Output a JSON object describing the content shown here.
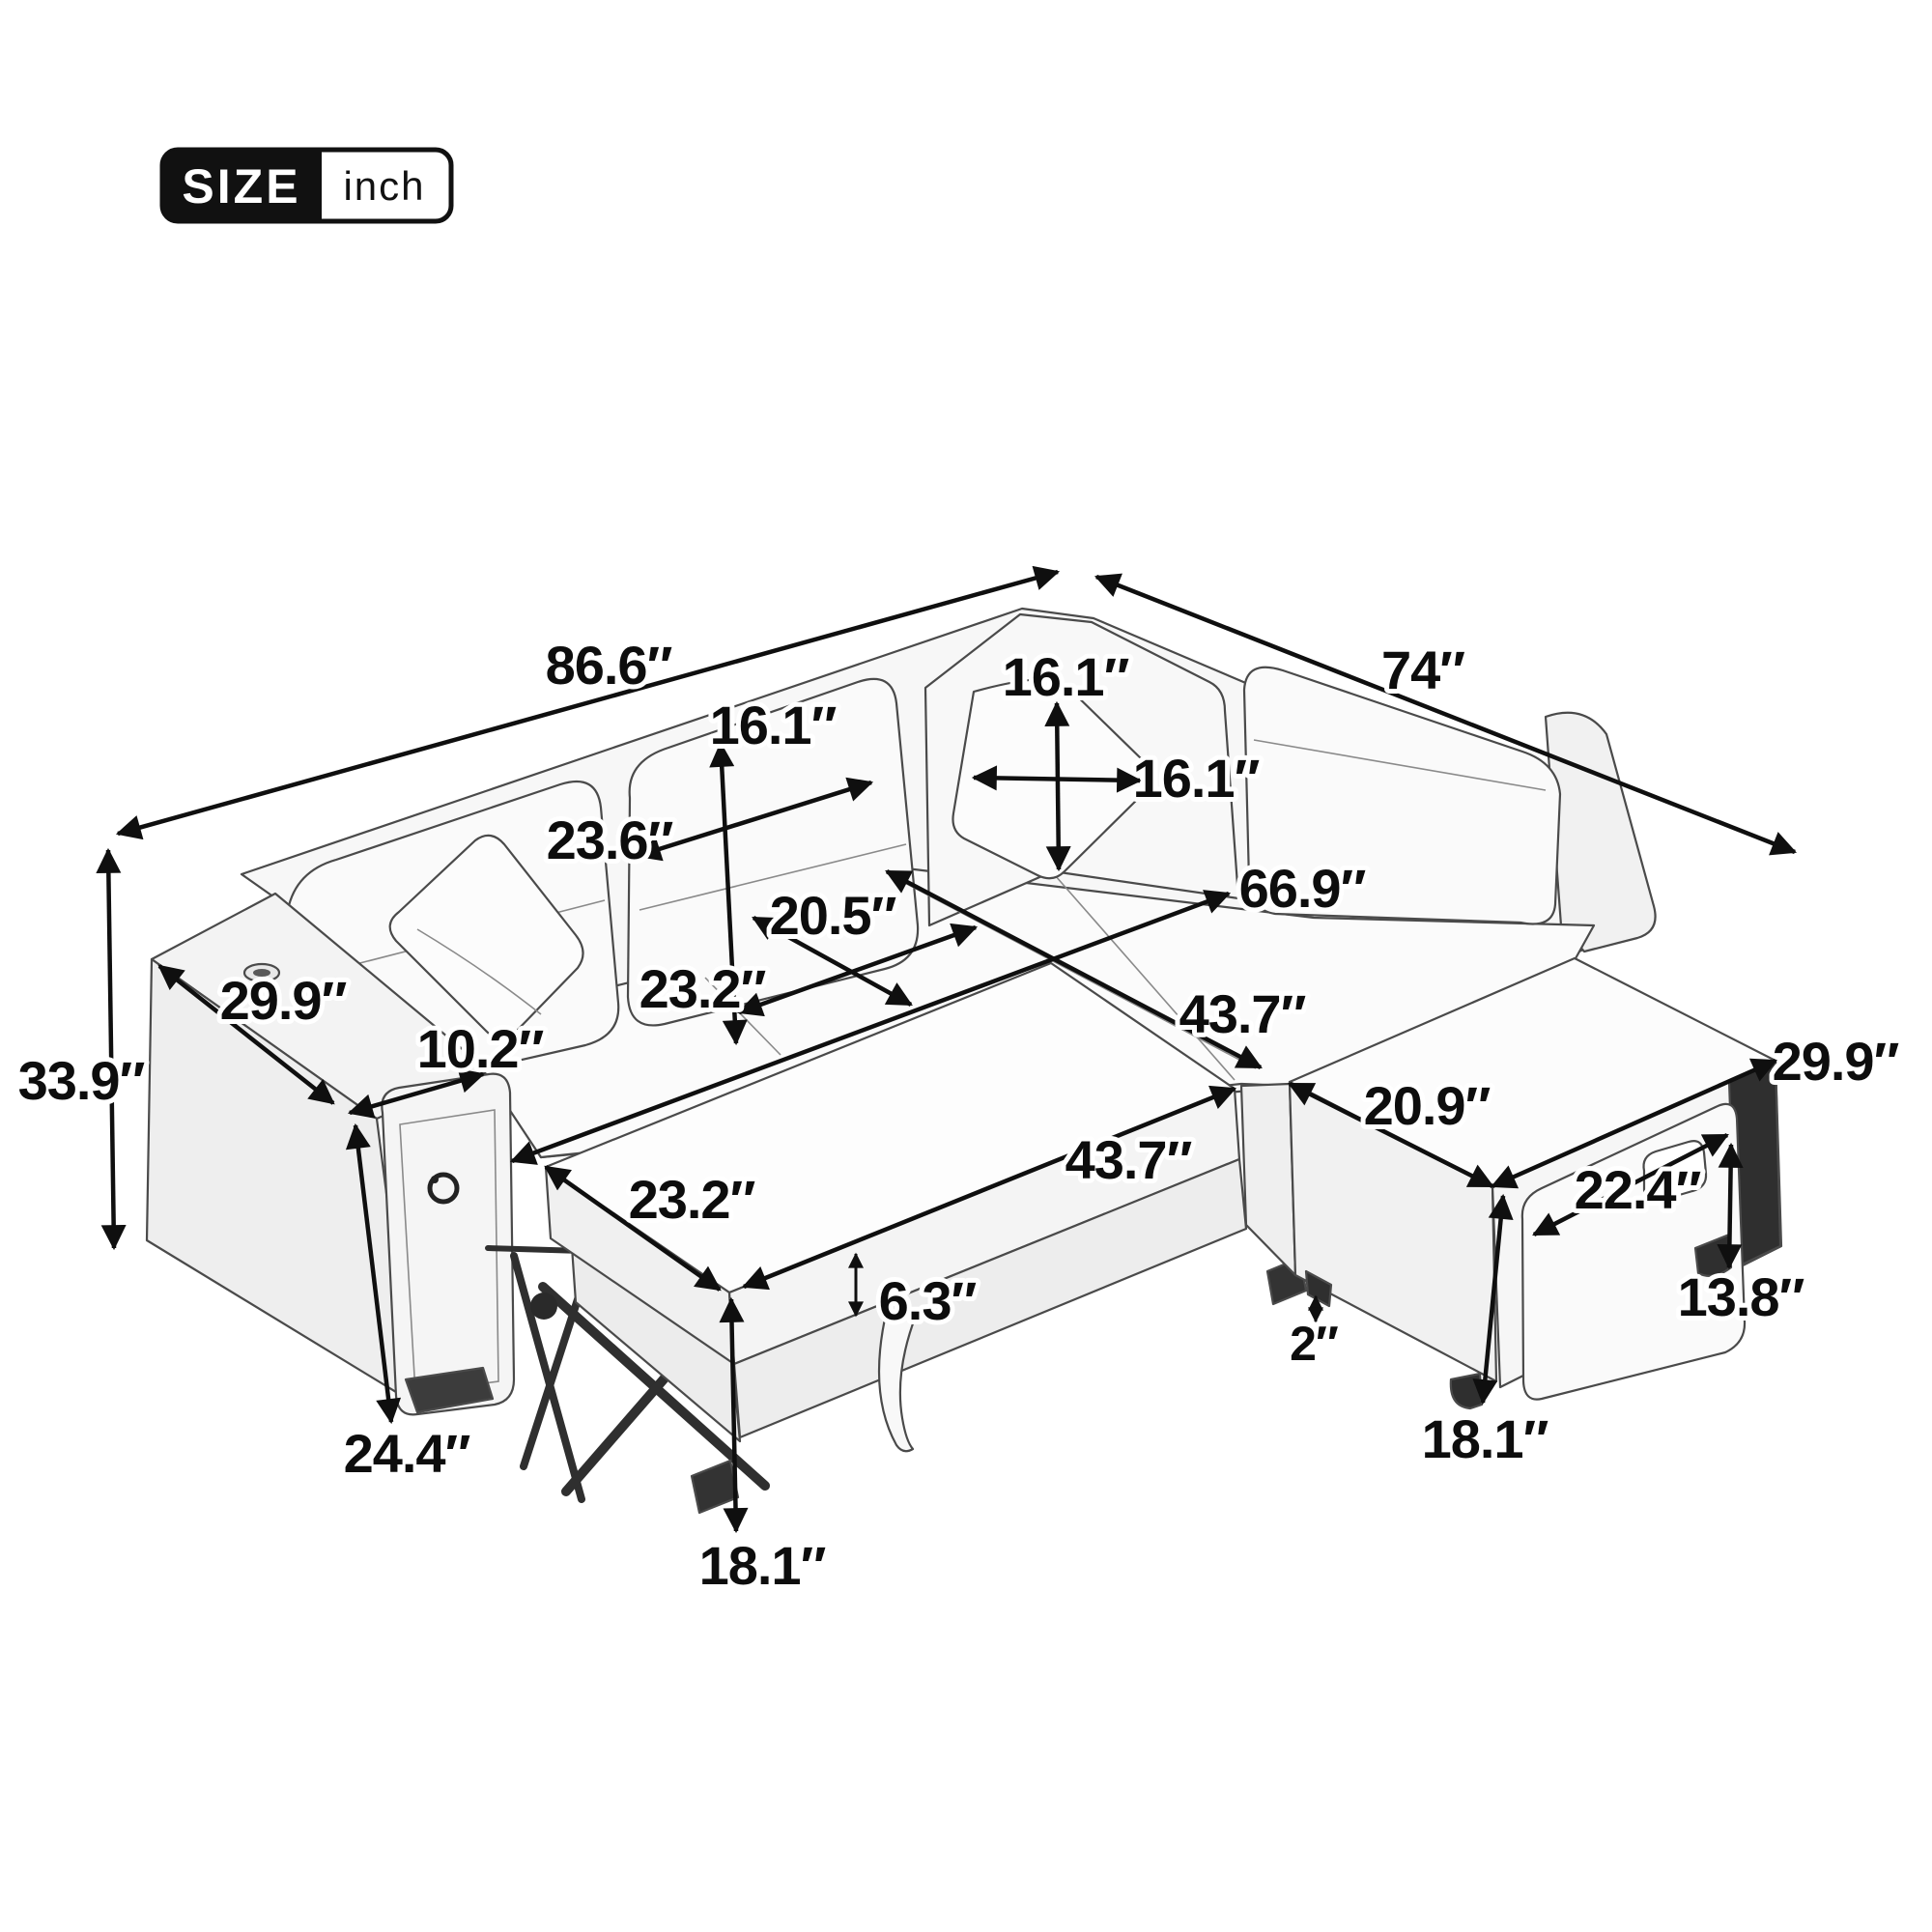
{
  "badge": {
    "size_label": "SIZE",
    "unit_label": "inch"
  },
  "diagram": {
    "type": "furniture-dimension-diagram",
    "subject": "L-shaped sectional sleeper sofa with pulled-out bed, storage chaise, USB arm console and throw pillows",
    "unit": "inch",
    "line_color": "#0f0f0f",
    "art_color": "#4a4a4a",
    "background": "#ffffff"
  },
  "dimensions": {
    "overall_back_width": "86.6″",
    "overall_right_depth": "74″",
    "back_cushion_height": "16.1″",
    "pillow_height": "16.1″",
    "pillow_width": "16.1″",
    "back_cushion_width": "23.6″",
    "seat_depth": "20.5″",
    "seat_width": "23.2″",
    "interior_length": "66.9″",
    "arm_length": "29.9″",
    "arm_top_width": "10.2″",
    "overall_height": "33.9″",
    "pullout_top_length": "43.7″",
    "pullout_depth": "23.2″",
    "pullout_front_length": "43.7″",
    "mattress_thickness": "6.3″",
    "chaise_seat_width": "20.9″",
    "chaise_depth": "29.9″",
    "drawer_width": "22.4″",
    "drawer_height": "13.8″",
    "leg_clearance": "2″",
    "chaise_height": "18.1″",
    "arm_front_height": "24.4″",
    "pullout_height": "18.1″"
  }
}
